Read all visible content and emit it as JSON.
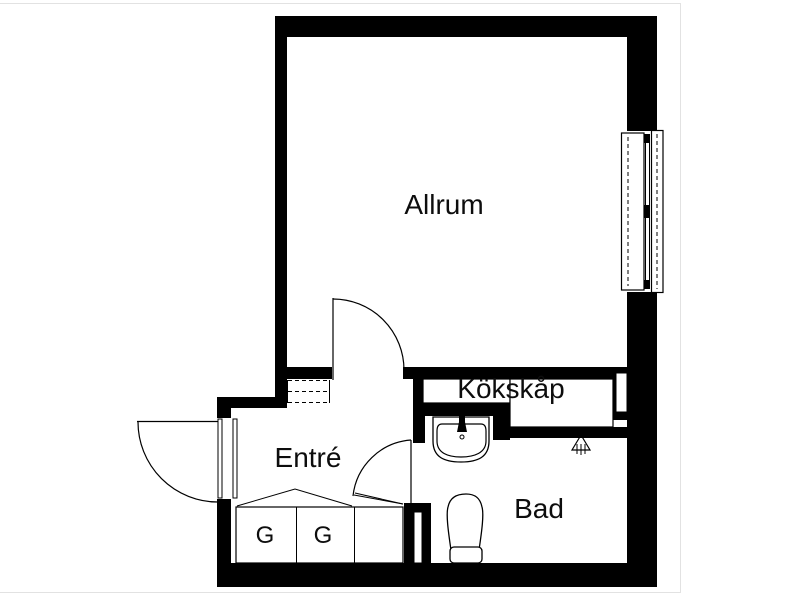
{
  "page": {
    "background_color": "#ffffff",
    "wall_color": "#000000",
    "line_color": "#000000",
    "faint_frame_color": "#e2e2e2"
  },
  "floorplan": {
    "rooms": [
      {
        "id": "allrum",
        "label": "Allrum"
      },
      {
        "id": "kokskap",
        "label": "Kökskåp"
      },
      {
        "id": "entre",
        "label": "Entré"
      },
      {
        "id": "bad",
        "label": "Bad"
      }
    ],
    "closets": [
      {
        "id": "closet-1",
        "label": "G"
      },
      {
        "id": "closet-2",
        "label": "G"
      },
      {
        "id": "closet-3",
        "label": ""
      }
    ],
    "fixtures": [
      "window-double-casement",
      "entry-door-outswing",
      "allrum-door-swing",
      "bad-door-swing",
      "bathroom-sink-with-tap",
      "toilet",
      "shower-floor-drain-symbol",
      "overhead-cabinet-dashed",
      "wardrobe-rail-symbol",
      "wall-shaft-slots"
    ]
  }
}
